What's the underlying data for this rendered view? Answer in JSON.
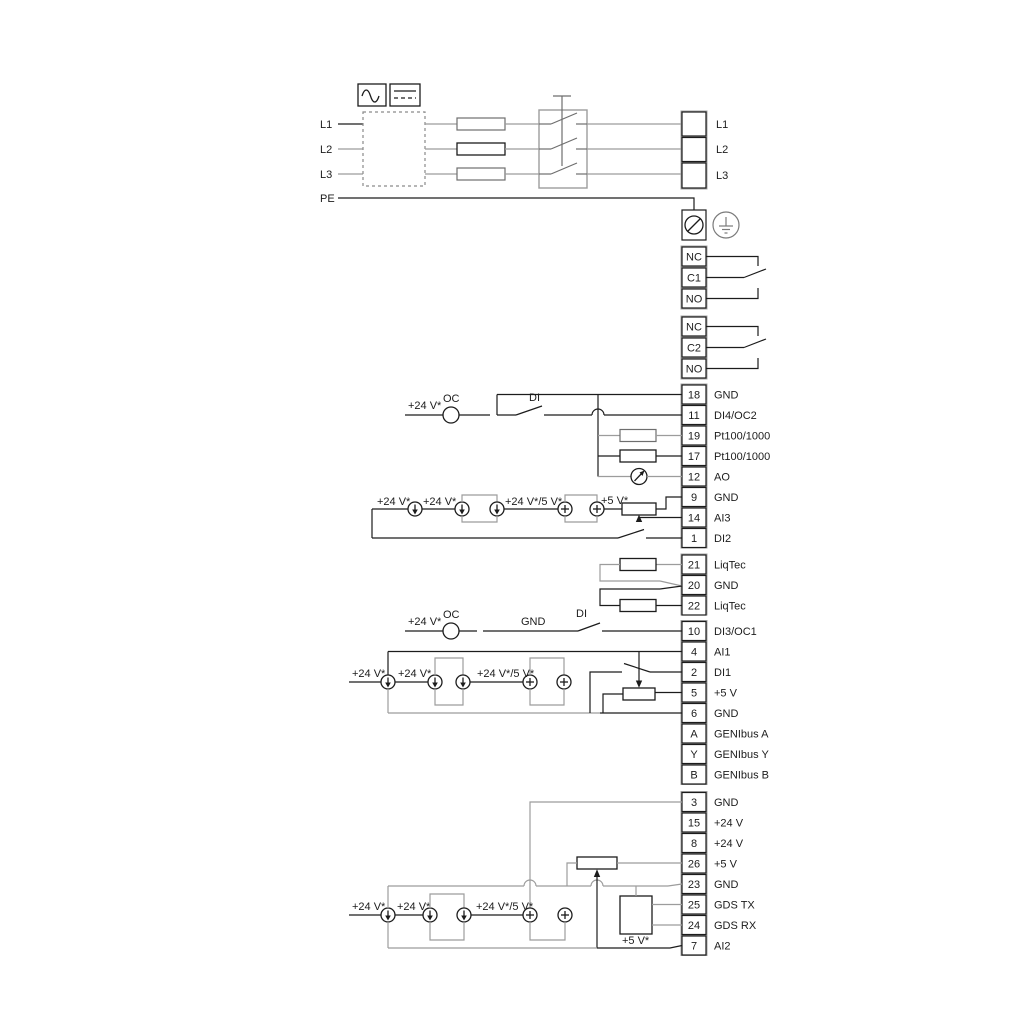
{
  "power": {
    "inputs": {
      "l1": "L1",
      "l2": "L2",
      "l3": "L3",
      "pe": "PE"
    },
    "outputs": {
      "l1": "L1",
      "l2": "L2",
      "l3": "L3"
    }
  },
  "relay1": {
    "rows": [
      "NC",
      "C1",
      "NO"
    ]
  },
  "relay2": {
    "rows": [
      "NC",
      "C2",
      "NO"
    ]
  },
  "group1": {
    "rows": [
      {
        "n": "18",
        "l": "GND"
      },
      {
        "n": "11",
        "l": "DI4/OC2"
      },
      {
        "n": "19",
        "l": "Pt100/1000"
      },
      {
        "n": "17",
        "l": "Pt100/1000"
      },
      {
        "n": "12",
        "l": "AO"
      },
      {
        "n": "9",
        "l": "GND"
      },
      {
        "n": "14",
        "l": "AI3"
      },
      {
        "n": "1",
        "l": "DI2"
      }
    ]
  },
  "liqtec": {
    "rows": [
      {
        "n": "21",
        "l": "LiqTec"
      },
      {
        "n": "20",
        "l": "GND"
      },
      {
        "n": "22",
        "l": "LiqTec"
      }
    ]
  },
  "group2": {
    "rows": [
      {
        "n": "10",
        "l": "DI3/OC1"
      },
      {
        "n": "4",
        "l": "AI1"
      },
      {
        "n": "2",
        "l": "DI1"
      },
      {
        "n": "5",
        "l": "+5 V"
      },
      {
        "n": "6",
        "l": "GND"
      },
      {
        "n": "A",
        "l": "GENIbus A"
      },
      {
        "n": "Y",
        "l": "GENIbus Y"
      },
      {
        "n": "B",
        "l": "GENIbus B"
      }
    ]
  },
  "group3": {
    "rows": [
      {
        "n": "3",
        "l": "GND"
      },
      {
        "n": "15",
        "l": "+24 V"
      },
      {
        "n": "8",
        "l": "+24 V"
      },
      {
        "n": "26",
        "l": "+5 V"
      },
      {
        "n": "23",
        "l": "GND"
      },
      {
        "n": "25",
        "l": "GDS TX"
      },
      {
        "n": "24",
        "l": "GDS RX"
      },
      {
        "n": "7",
        "l": "AI2"
      }
    ]
  },
  "ann": {
    "oc_di4": {
      "v24": "+24 V*",
      "oc": "OC",
      "di": "DI"
    },
    "ai3": {
      "v24a": "+24 V*",
      "v24b": "+24 V*",
      "v245": "+24 V*/5 V*",
      "v5": "+5 V*"
    },
    "oc_di3": {
      "v24": "+24 V*",
      "oc": "OC",
      "gnd": "GND",
      "di": "DI"
    },
    "ai1": {
      "v24a": "+24 V*",
      "v24b": "+24 V*",
      "v245": "+24 V*/5 V*"
    },
    "ai2": {
      "v24a": "+24 V*",
      "v24b": "+24 V*",
      "v245": "+24 V*/5 V*",
      "v5": "+5 V*"
    }
  },
  "colors": {
    "line": "#1c1c1c",
    "gray": "#9c9c9c"
  }
}
